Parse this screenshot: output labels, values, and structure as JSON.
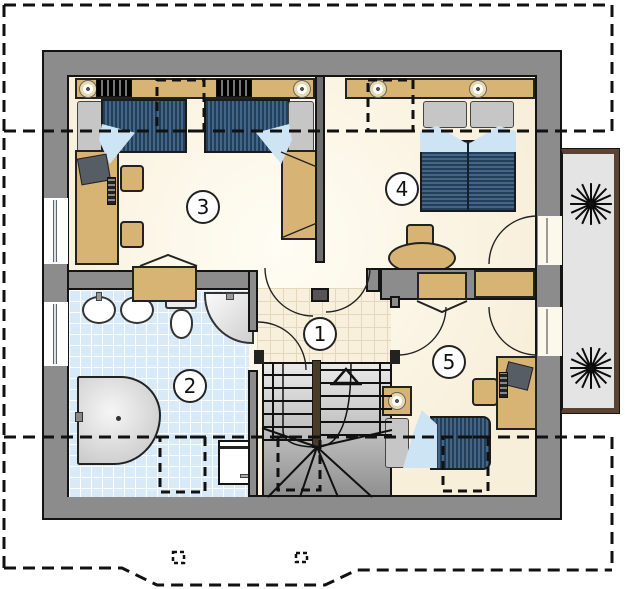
{
  "plan": {
    "title": "attic floor plan",
    "rooms": [
      {
        "number": "1",
        "name": "hall"
      },
      {
        "number": "2",
        "name": "bathroom"
      },
      {
        "number": "3",
        "name": "bedroom-twin"
      },
      {
        "number": "4",
        "name": "bedroom-double"
      },
      {
        "number": "5",
        "name": "bedroom-single"
      }
    ],
    "stairs": {
      "icon": "up-arrow",
      "flights": 2
    },
    "balcony": {
      "plants": 2,
      "plant_icon": "potted-plant"
    },
    "roof_outline": {
      "style": "dashed",
      "eave_lines": 2
    },
    "colors": {
      "wall": "#8c8c8c",
      "outline": "#141414",
      "floor": "#f8efda",
      "hall_tile": "#f8f0dc",
      "bath_tile": "#d8e9f8",
      "furniture": "#d7b374",
      "bed_cover": "#30506f",
      "blanket": "#cde4f5",
      "pillow": "#c6c6c6",
      "stair_rail": "#4a3a28",
      "balcony_floor": "#e4e4e4",
      "balcony_rail": "#5b4333",
      "plant": "#111111"
    }
  }
}
